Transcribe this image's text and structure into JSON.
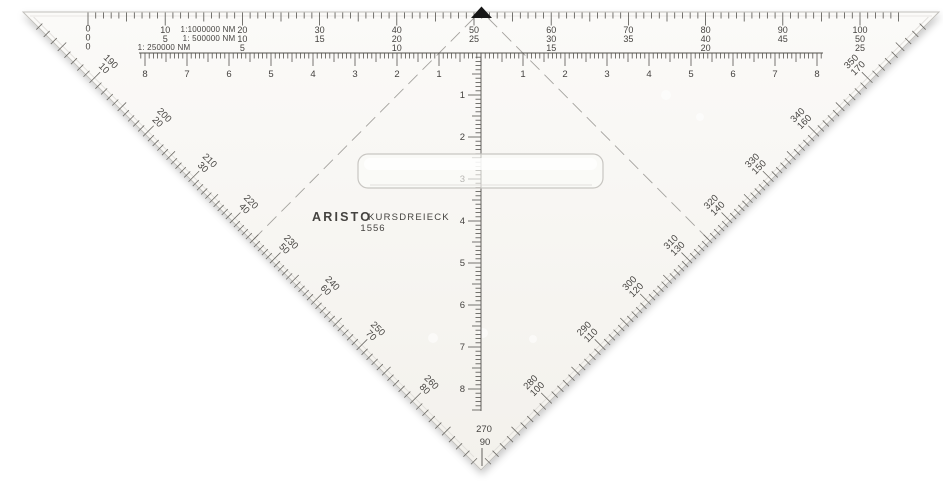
{
  "brand": {
    "name": "ARISTO",
    "product": "KURSDREIECK",
    "model": "1556"
  },
  "top_scales": {
    "rows": [
      {
        "scale_label": "1:1000000 NM",
        "zero": "0",
        "values": [
          "10",
          "20",
          "30",
          "40",
          "50",
          "60",
          "70",
          "80",
          "90",
          "100"
        ]
      },
      {
        "scale_label": "1: 500000 NM",
        "zero": "0",
        "values": [
          "5",
          "10",
          "15",
          "20",
          "25",
          "30",
          "35",
          "40",
          "45",
          "50"
        ]
      },
      {
        "scale_label": "1: 250000 NM",
        "zero": "0",
        "values": [
          "",
          "5",
          "",
          "10",
          "",
          "15",
          "",
          "20",
          "",
          "25"
        ]
      }
    ]
  },
  "hypotenuse_ruler": {
    "left_numbers": [
      "8",
      "7",
      "6",
      "5",
      "4",
      "3",
      "2",
      "1"
    ],
    "right_numbers": [
      "1",
      "2",
      "3",
      "4",
      "5",
      "6",
      "7",
      "8"
    ]
  },
  "vertical_ruler": {
    "numbers": [
      "1",
      "2",
      "3",
      "4",
      "5",
      "6",
      "7",
      "8"
    ]
  },
  "protractor": {
    "left_edge": [
      [
        "190",
        "10"
      ],
      [
        "200",
        "20"
      ],
      [
        "210",
        "30"
      ],
      [
        "220",
        "40"
      ],
      [
        "230",
        "50"
      ],
      [
        "240",
        "60"
      ],
      [
        "250",
        "70"
      ],
      [
        "260",
        "80"
      ]
    ],
    "apex": [
      "270",
      "90"
    ],
    "right_edge": [
      [
        "280",
        "100"
      ],
      [
        "290",
        "110"
      ],
      [
        "300",
        "120"
      ],
      [
        "310",
        "130"
      ],
      [
        "320",
        "140"
      ],
      [
        "330",
        "150"
      ],
      [
        "340",
        "160"
      ],
      [
        "350",
        "170"
      ]
    ]
  },
  "marker": {
    "label": "index-marker",
    "color": "#161616"
  },
  "colors": {
    "background": "#ffffff",
    "acrylic_top": "#fbfaf8",
    "acrylic_bottom": "#f3f1ec",
    "edge": "#c2c0bc",
    "bevel": "#dedcd8",
    "ink": "#454340",
    "tick": "#54524e",
    "degree_tick": "#6b6964",
    "guide_line": "#a4a29e"
  }
}
